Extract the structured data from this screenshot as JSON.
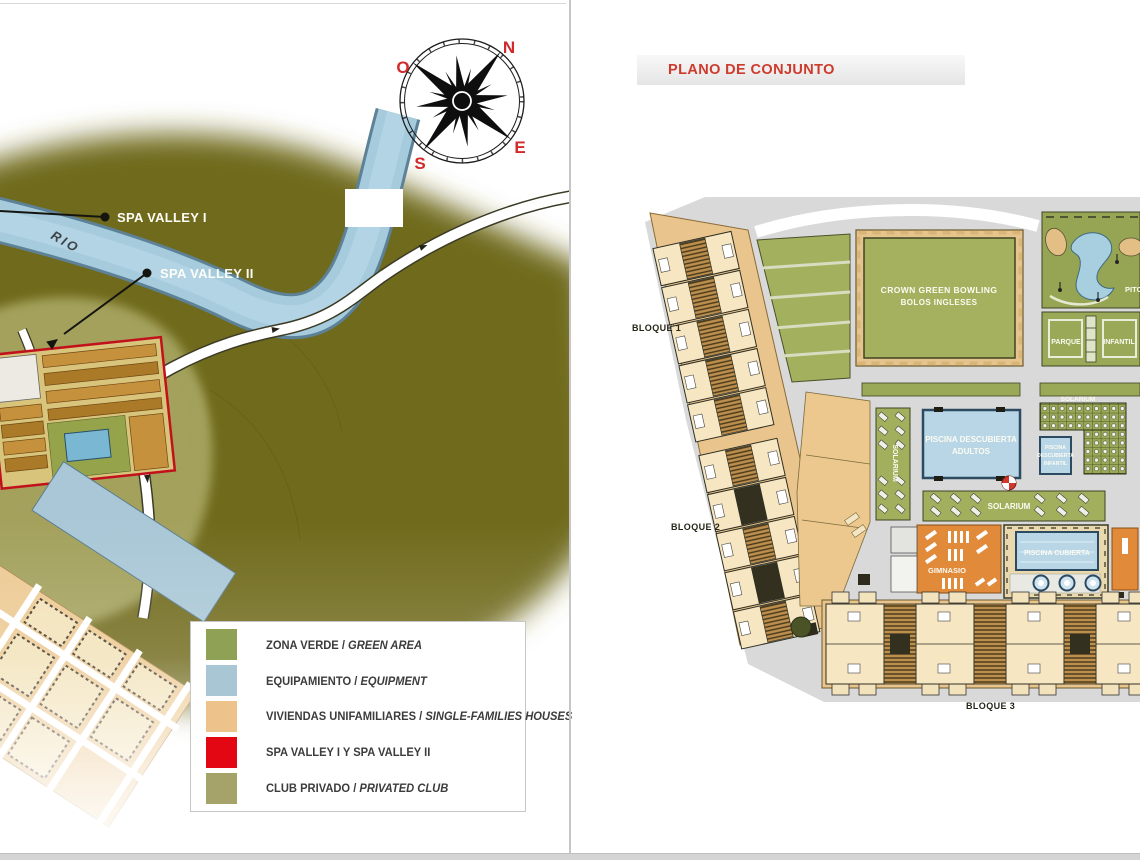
{
  "left_panel": {
    "compass": {
      "north": "N",
      "west": "O",
      "east": "E",
      "south": "S"
    },
    "river_label": "RIO",
    "marker1": "SPA VALLEY I",
    "marker2": "SPA VALLEY II",
    "legend": {
      "items": [
        {
          "label": "ZONA VERDE / ",
          "italic": "GREEN AREA",
          "color": "#8fa155"
        },
        {
          "label": "EQUIPAMIENTO / ",
          "italic": "EQUIPMENT",
          "color": "#a9c6d5"
        },
        {
          "label": "VIVIENDAS UNIFAMILIARES / ",
          "italic": "SINGLE-FAMILIES HOUSES",
          "color": "#eec28b"
        },
        {
          "label": "SPA VALLEY I Y SPA VALLEY II",
          "italic": "",
          "color": "#e30613"
        },
        {
          "label": "CLUB PRIVADO / ",
          "italic": "PRIVATED CLUB",
          "color": "#a6a36a"
        }
      ]
    }
  },
  "right_panel": {
    "header": "PLANO DE CONJUNTO",
    "block1": "BLOQUE 1",
    "block2": "BLOQUE 2",
    "block3": "BLOQUE 3",
    "bowling_green": {
      "line1": "CROWN GREEN BOWLING",
      "line2": "BOLOS INGLESES"
    },
    "pitch_putt_partial": "PITCH",
    "playground": {
      "left": "PARQUE",
      "right": "INFANTIL"
    },
    "outdoor_pool": {
      "line1": "PISCINA DESCUBIERTA",
      "line2": "ADULTOS"
    },
    "kids_pool": {
      "line1": "PISCINA",
      "line2": "DESCUBIERTA",
      "line3": "INFANTIL"
    },
    "solarium_pergola": "SOLARIUM",
    "solarium_side": "SOLARIUM",
    "solarium_main": "SOLARIUM",
    "gym": "GIMNASIO",
    "indoor_pool": "PISCINA CUBIERTA"
  },
  "colors": {
    "title_red": "#ce3a2c",
    "compass_red": "#d2292b",
    "map_olive": "#6f6a1d",
    "club_green": "#a3a15c",
    "river_blue": "#a5cbdd",
    "plan_green": "#9fae5a",
    "plan_tan": "#e9c48c",
    "pool_blue": "#b9d6e6",
    "gym_orange": "#e08a3a",
    "spa_red": "#e30613",
    "road_gray": "#d9d9d9"
  }
}
